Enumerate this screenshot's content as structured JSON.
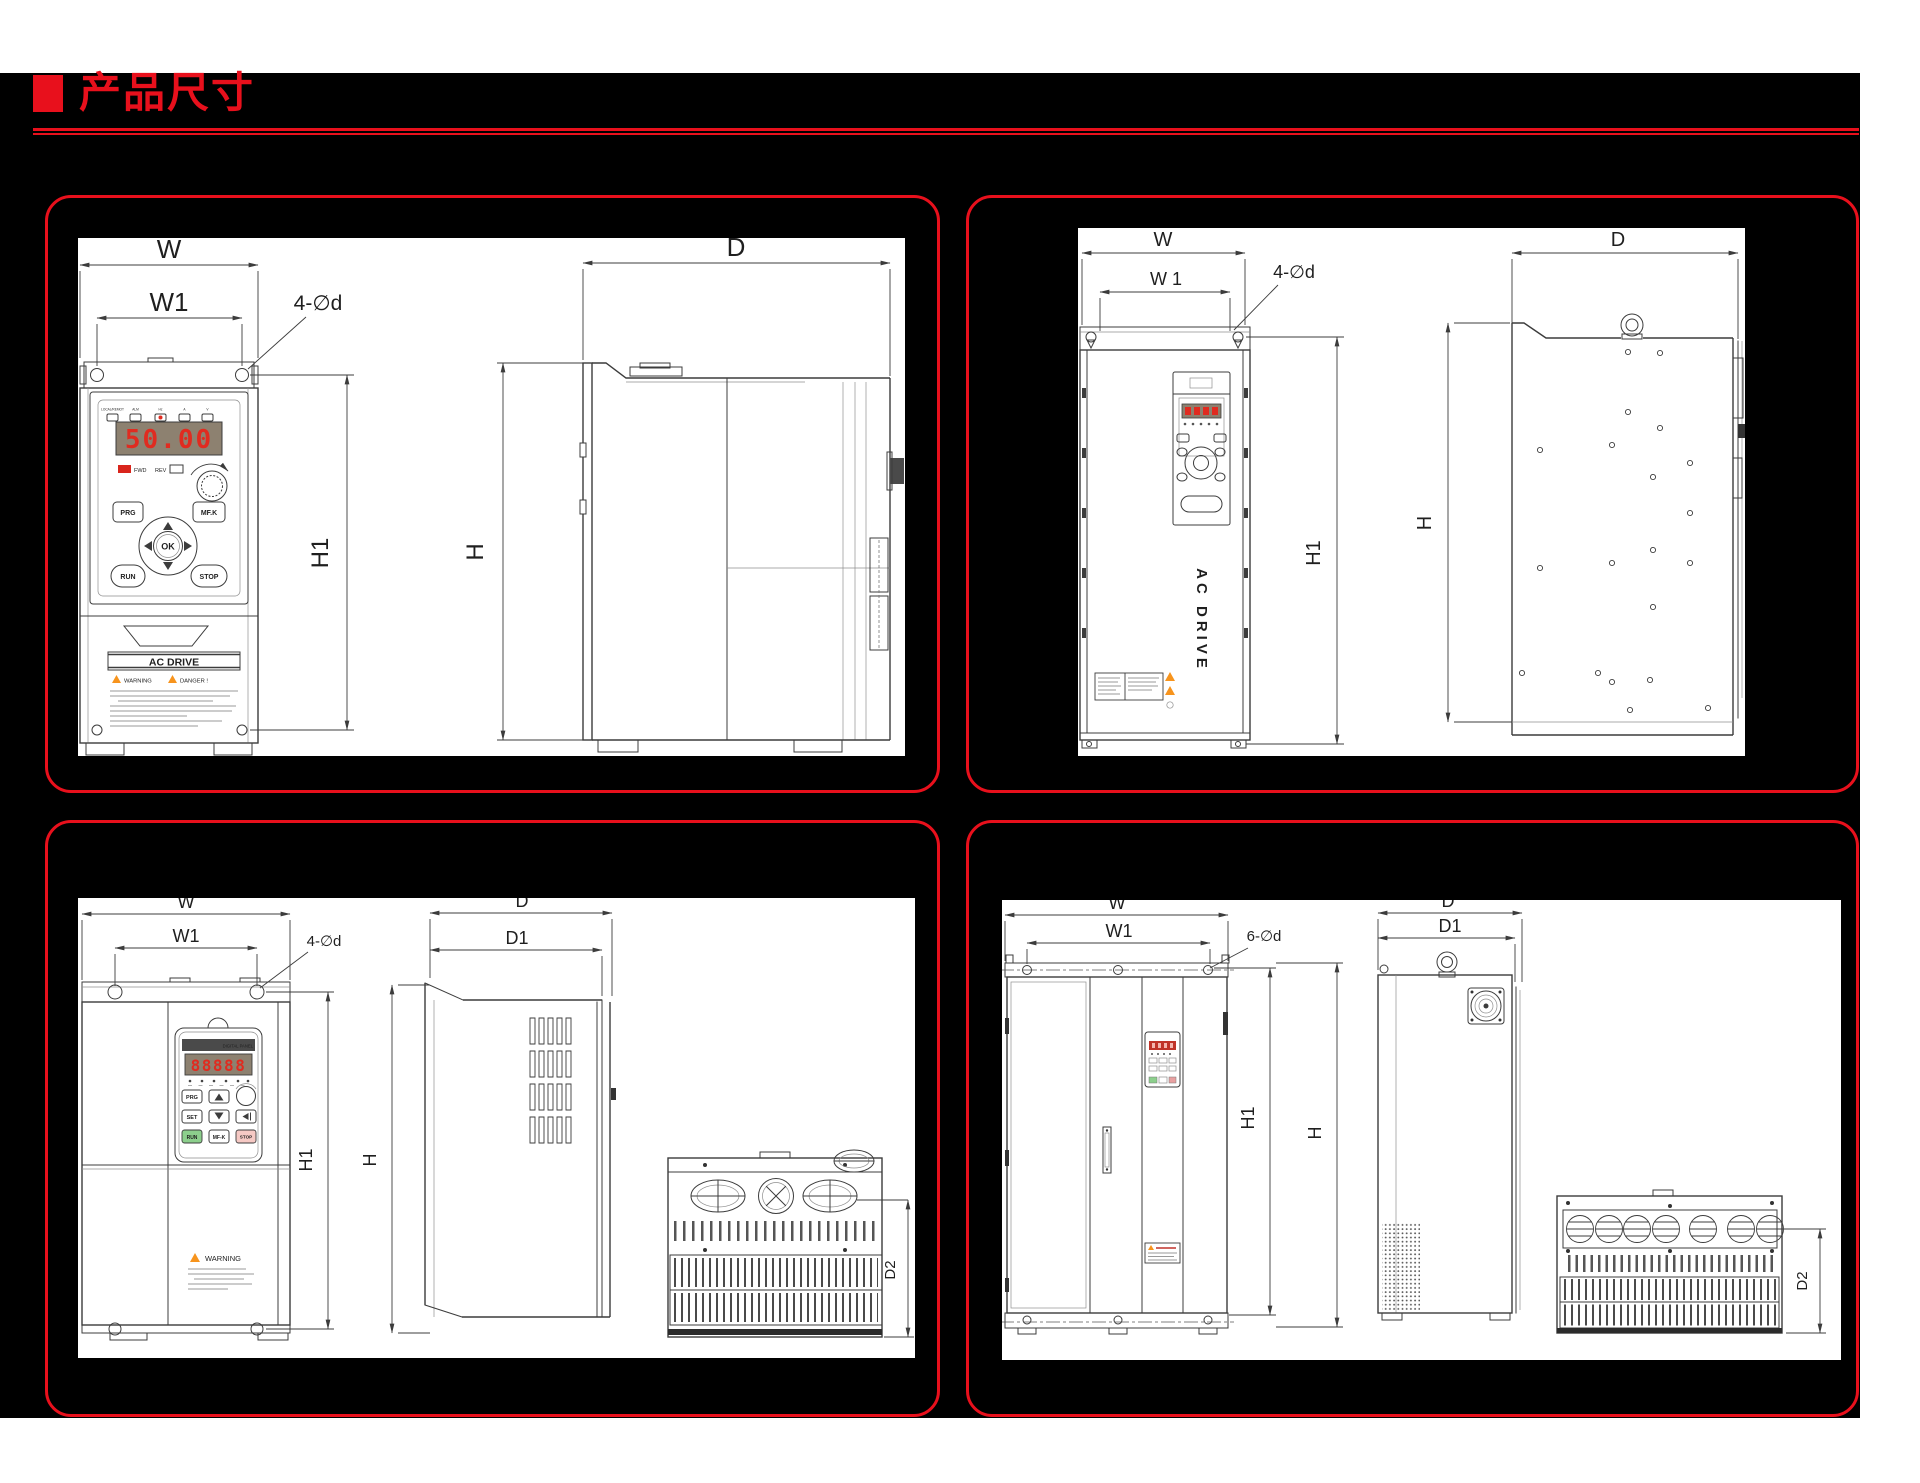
{
  "page": {
    "title": "产品尺寸"
  },
  "colors": {
    "accent": "#e8101c",
    "display_digit": "#e02b20",
    "warning_orange": "#f7941d",
    "run_green": "#8ccf8c",
    "stop_pink": "#f6c9c4",
    "background": "#000000"
  },
  "tl": {
    "w": "W",
    "w1": "W1",
    "holes": "4-∅d",
    "h1": "H1",
    "d": "D",
    "h": "H",
    "display": "50.00",
    "leds": [
      "LOCAL/REMOT",
      "ALM",
      "Hz",
      "A",
      "V"
    ],
    "fwd": "FWD",
    "rev": "REV",
    "prg": "PRG",
    "mfk": "MF.K",
    "ok": "OK",
    "run": "RUN",
    "stop": "STOP",
    "brand": "AC DRIVE",
    "warning": "WARNING",
    "danger": "DANGER !"
  },
  "tr": {
    "w": "W",
    "w1": "W 1",
    "holes": "4-∅d",
    "h1": "H1",
    "d": "D",
    "h": "H",
    "brand": "AC DRIVE"
  },
  "bl": {
    "w": "W",
    "w1": "W1",
    "holes": "4-∅d",
    "h1": "H1",
    "d": "D",
    "d1": "D1",
    "h": "H",
    "d2": "D2",
    "kp_header": "DIGITAL PANEL",
    "display": "88888",
    "prg": "PRG",
    "set": "SET",
    "run": "RUN",
    "mfk": "MF-K",
    "stop": "STOP",
    "warning": "WARNING"
  },
  "br": {
    "w": "W",
    "w1": "W1",
    "holes": "6-∅d",
    "h1": "H1",
    "d": "D",
    "d1": "D1",
    "h": "H",
    "d2": "D2"
  }
}
